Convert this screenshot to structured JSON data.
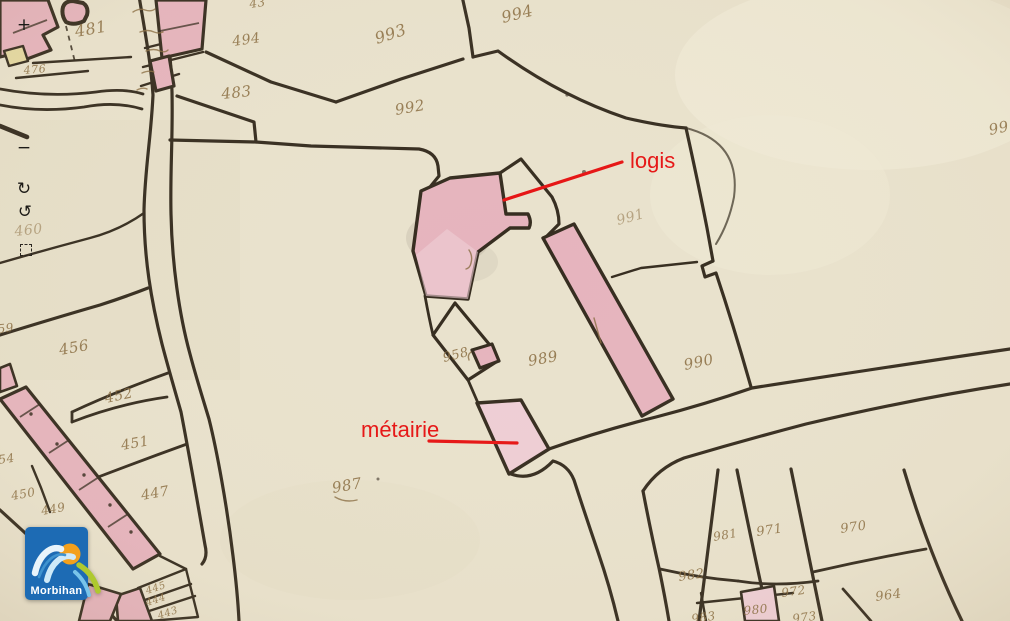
{
  "viewer": {
    "controls": [
      {
        "name": "zoom-in",
        "glyph": "+",
        "kind": "glyph",
        "x": 24,
        "y": 25
      },
      {
        "name": "zoom-out",
        "glyph": "−",
        "kind": "glyph",
        "x": 24,
        "y": 148
      },
      {
        "name": "rotate-cw",
        "glyph": "↻",
        "kind": "glyph",
        "x": 24,
        "y": 189
      },
      {
        "name": "rotate-ccw",
        "glyph": "↺",
        "kind": "glyph",
        "x": 25,
        "y": 212
      },
      {
        "name": "select-area",
        "glyph": "",
        "kind": "dashed-square",
        "x": 26,
        "y": 250
      }
    ],
    "logo": {
      "text": "Morbihan"
    }
  },
  "map": {
    "colors": {
      "paper": "#e9e2cd",
      "line": "#352c1f",
      "ink": "#8a6d42",
      "bldg": "#e6b4be",
      "bldg-light": "#eeced5",
      "ybldg": "#e5d9a2",
      "red": "#e61313",
      "logo-blue": "#1d6bb4",
      "logo-sun": "#f3a01c",
      "logo-wave": "#e8f4fb",
      "logo-leaf": "#aec92f",
      "logo-water": "#79c4e9"
    },
    "parcel_numbers": [
      {
        "text": "481",
        "x": 76,
        "y": 37,
        "r": -10,
        "s": 16
      },
      {
        "text": "476",
        "x": 24,
        "y": 74,
        "r": -5,
        "s": 11
      },
      {
        "text": "43",
        "x": 250,
        "y": 8,
        "r": -8,
        "s": 12
      },
      {
        "text": "494",
        "x": 233,
        "y": 46,
        "r": -8,
        "s": 14
      },
      {
        "text": "483",
        "x": 222,
        "y": 99,
        "r": -6,
        "s": 15
      },
      {
        "text": "993",
        "x": 377,
        "y": 44,
        "r": -18,
        "s": 16
      },
      {
        "text": "994",
        "x": 503,
        "y": 23,
        "r": -14,
        "s": 16
      },
      {
        "text": "992",
        "x": 396,
        "y": 115,
        "r": -10,
        "s": 15
      },
      {
        "text": "991",
        "x": 618,
        "y": 225,
        "r": -15,
        "s": 14,
        "faint": true
      },
      {
        "text": "99",
        "x": 990,
        "y": 135,
        "r": -12,
        "s": 15
      },
      {
        "text": "460",
        "x": 15,
        "y": 236,
        "r": -6,
        "s": 14,
        "faint": true
      },
      {
        "text": "459",
        "x": -10,
        "y": 334,
        "r": -6,
        "s": 12
      },
      {
        "text": "456",
        "x": 60,
        "y": 355,
        "r": -10,
        "s": 15
      },
      {
        "text": "452",
        "x": 106,
        "y": 403,
        "r": -12,
        "s": 14
      },
      {
        "text": "451",
        "x": 122,
        "y": 450,
        "r": -10,
        "s": 14
      },
      {
        "text": "447",
        "x": 142,
        "y": 500,
        "r": -10,
        "s": 14
      },
      {
        "text": "450",
        "x": 12,
        "y": 500,
        "r": -10,
        "s": 12
      },
      {
        "text": "449",
        "x": 42,
        "y": 515,
        "r": -10,
        "s": 12
      },
      {
        "text": "454",
        "x": -9,
        "y": 465,
        "r": -8,
        "s": 12
      },
      {
        "text": "987",
        "x": 333,
        "y": 493,
        "r": -10,
        "s": 15
      },
      {
        "text": "958",
        "x": 444,
        "y": 362,
        "r": -14,
        "s": 13
      },
      {
        "text": "989",
        "x": 529,
        "y": 366,
        "r": -10,
        "s": 15
      },
      {
        "text": "990",
        "x": 685,
        "y": 370,
        "r": -12,
        "s": 15
      },
      {
        "text": "981",
        "x": 714,
        "y": 541,
        "r": -10,
        "s": 12
      },
      {
        "text": "971",
        "x": 757,
        "y": 536,
        "r": -8,
        "s": 13
      },
      {
        "text": "970",
        "x": 841,
        "y": 533,
        "r": -8,
        "s": 13
      },
      {
        "text": "982",
        "x": 679,
        "y": 581,
        "r": -8,
        "s": 13
      },
      {
        "text": "972",
        "x": 782,
        "y": 597,
        "r": -8,
        "s": 12
      },
      {
        "text": "980",
        "x": 744,
        "y": 615,
        "r": -6,
        "s": 12
      },
      {
        "text": "983",
        "x": 692,
        "y": 623,
        "r": -8,
        "s": 12
      },
      {
        "text": "973",
        "x": 793,
        "y": 623,
        "r": -8,
        "s": 12
      },
      {
        "text": "964",
        "x": 876,
        "y": 601,
        "r": -8,
        "s": 13
      },
      {
        "text": "445",
        "x": 147,
        "y": 594,
        "r": -18,
        "s": 10
      },
      {
        "text": "444",
        "x": 147,
        "y": 606,
        "r": -18,
        "s": 10
      },
      {
        "text": "443",
        "x": 159,
        "y": 619,
        "r": -18,
        "s": 10
      }
    ],
    "annotations": [
      {
        "id": "logis",
        "text": "logis",
        "tx": 630,
        "ty": 168,
        "size": 22,
        "line": {
          "x1": 622,
          "y1": 162,
          "x2": 504,
          "y2": 200
        }
      },
      {
        "id": "metairie",
        "text": "métairie",
        "tx": 361,
        "ty": 437,
        "size": 22,
        "line": {
          "x1": 429,
          "y1": 441,
          "x2": 517,
          "y2": 443
        }
      }
    ]
  }
}
